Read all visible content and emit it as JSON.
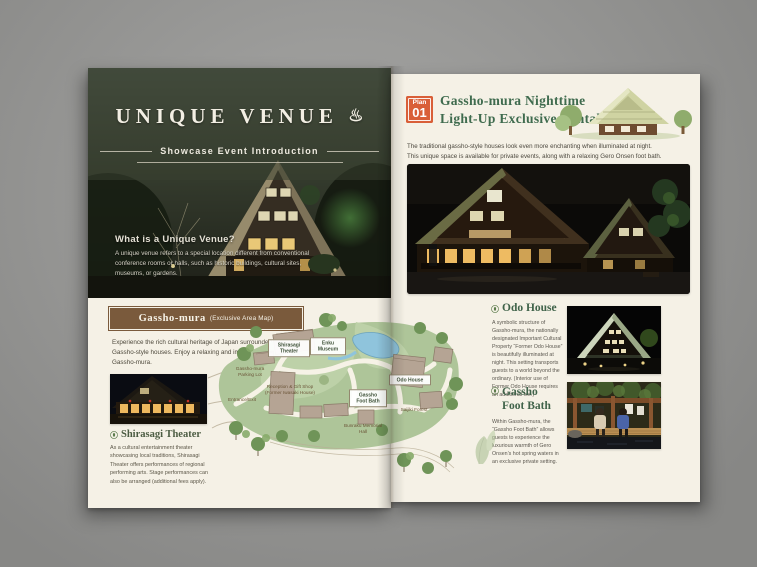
{
  "colors": {
    "backdrop_gray": "#9d9d9b",
    "paper_cream": "#f5f1e6",
    "hero_green": "#39402f",
    "accent_orange": "#d95f38",
    "heading_green": "#3f6b4e",
    "map_box_brown": "#7a5a3c",
    "map_green": "#aec599",
    "pond_blue": "#8fc4dc"
  },
  "left_page": {
    "hero": {
      "title": "UNIQUE VENUE",
      "onsen_icon": "♨",
      "subtitle": "Showcase Event Introduction",
      "heading": "What is a Unique Venue?",
      "body": "A unique venue refers to a special location different from conventional conference rooms or halls, such as historic buildings, cultural sites, museums, or gardens."
    },
    "map_section": {
      "title": "Gassho-mura",
      "title_suffix": "(Exclusive Area Map)",
      "intro": "Experience the rich cultural heritage of Japan surrounded by traditional Gassho-style houses. Enjoy a relaxing and immersive experience at Gassho-mura.",
      "labels": {
        "shirasagi": "Shirasagi Theater",
        "enku": "Enku Museum",
        "parking": "Gassho-mura Parking Lot",
        "reception": "Reception & Gift Shop (Former Iwasaki House)",
        "entrance": "Entrance/Exit",
        "odo": "Odo House",
        "footbath": "Gassho Foot Bath",
        "saijiki": "Saijiki Forest",
        "bunraku": "Bunraku Memorial Hall"
      }
    },
    "theater": {
      "heading": "Shirasagi Theater",
      "body": "As a cultural entertainment theater showcasing local traditions, Shirasagi Theater offers performances of regional performing arts. Stage performances can also be arranged (additional fees apply)."
    }
  },
  "right_page": {
    "plan_badge": {
      "label": "Plan",
      "number": "01"
    },
    "title_line1": "Gassho-mura Nighttime",
    "title_line2": "Light-Up Exclusive Rental",
    "intro_line1": "The traditional gassho-style houses look even more enchanting when illuminated at night.",
    "intro_line2": "This unique space is available for private events, along with a relaxing Gero Onsen foot bath.",
    "odo_house": {
      "heading": "Odo House",
      "body": "A symbolic structure of Gassho-mura, the nationally designated Important Cultural Property “Former Odo House” is beautifully illuminated at night. This setting transports guests to a world beyond the ordinary. (Interior use of Former Odo House requires an additional fee.)"
    },
    "foot_bath": {
      "heading_line1": "Gassho",
      "heading_line2": "Foot Bath",
      "body": "Within Gassho-mura, the “Gassho Foot Bath” allows guests to experience the luxurious warmth of Gero Onsen’s hot spring waters in an exclusive private setting."
    }
  }
}
